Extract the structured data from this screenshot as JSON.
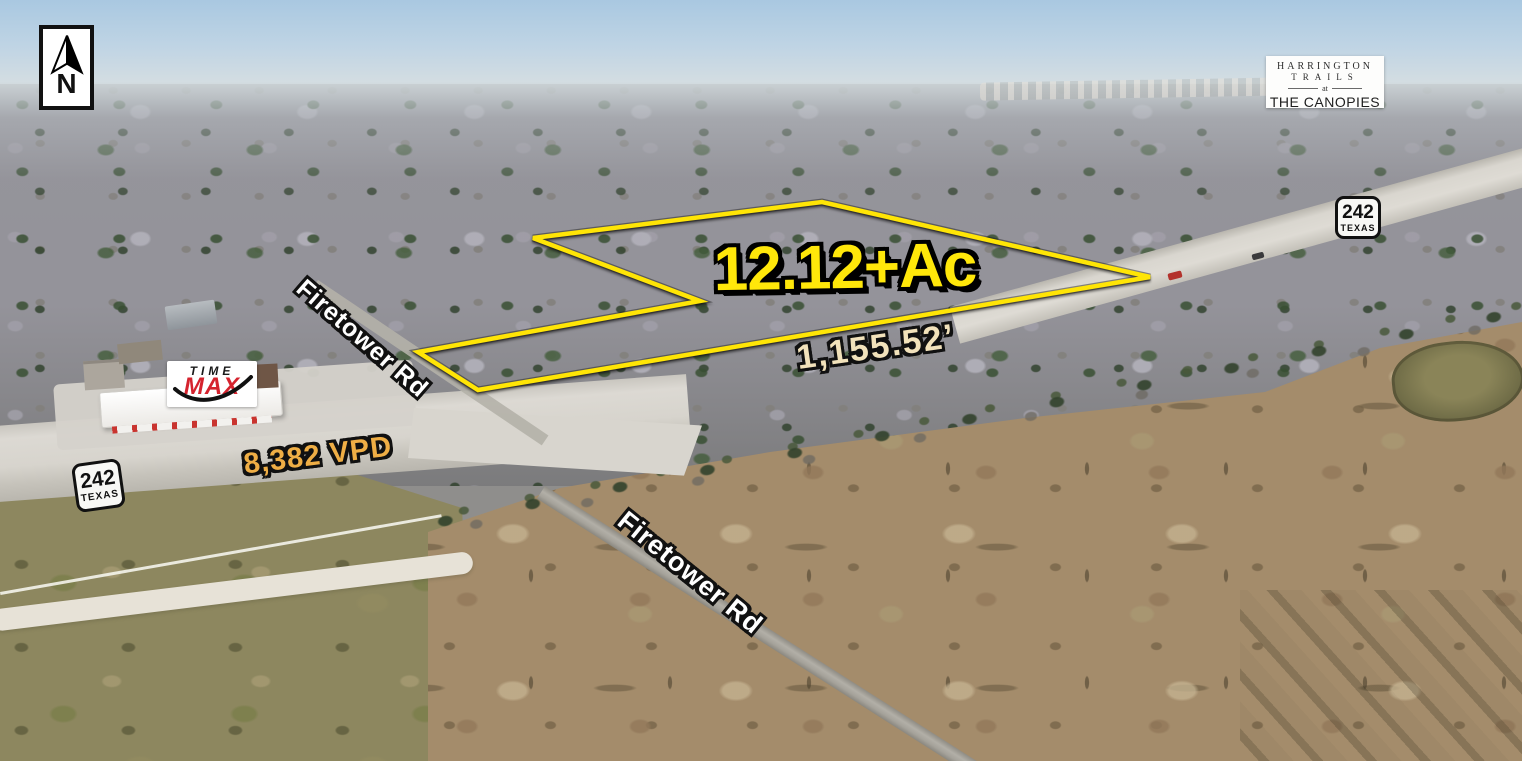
{
  "compass": {
    "label": "N"
  },
  "developer_logo": {
    "line1": "HARRINGTON",
    "line2": "TRAILS",
    "connector": "at",
    "line3": "THE CANOPIES"
  },
  "highway_shields": {
    "right": {
      "number": "242",
      "state": "TEXAS"
    },
    "left": {
      "number": "242",
      "state": "TEXAS"
    }
  },
  "parcel": {
    "acreage_label": "12.12+Ac",
    "frontage_label": "1,155.52’",
    "outline_points": "533,238 822,202 1150,277 478,390 418,352 700,301",
    "outline_color": "#ffe506"
  },
  "traffic": {
    "count_label": "8,382 VPD"
  },
  "road_labels": {
    "firetower_upper": "Firetower Rd",
    "firetower_lower": "Firetower Rd"
  },
  "business_sign": {
    "word1": "TIME",
    "word2": "MAX"
  },
  "colors": {
    "parcel_outline": "#ffe506",
    "acreage_text": "#ffe70a",
    "frontage_text": "#f2e2bb",
    "traffic_text": "#efae45",
    "road_label_text": "#ffffff",
    "sign_red": "#d5232e"
  }
}
